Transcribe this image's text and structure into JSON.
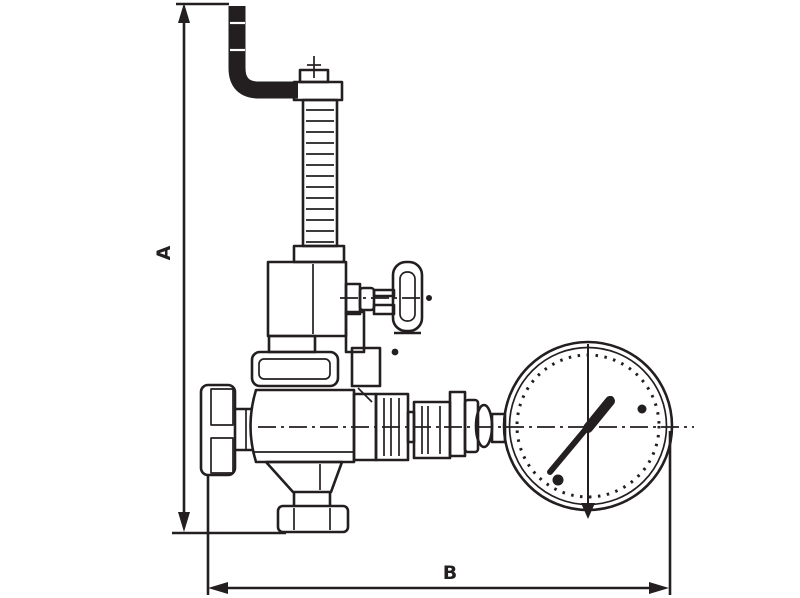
{
  "diagram": {
    "type": "technical-dimension-drawing",
    "subject": "bronze pressure reducing valve with T-handle shutoff, side handwheel and pressure gauge",
    "background_color": "#ffffff",
    "line_color": "#231f20",
    "dimensions": {
      "vertical_label": "A",
      "horizontal_label": "B"
    },
    "components": {
      "crank_pipe": "bent adjusting pipe (top)",
      "adjusting_screw": "adjusting screw with cross mark",
      "spring_housing": "threaded spring housing tube",
      "bonnet": "valve bonnet",
      "t_handle_valve": "side shutoff valve with T-handle",
      "handwheel": "side handwheel",
      "valve_body": "main valve body",
      "bottom_flange": "bottom outlet flange",
      "union_fittings": "outlet union fittings",
      "pressure_gauge": "round pressure gauge with needle"
    }
  }
}
